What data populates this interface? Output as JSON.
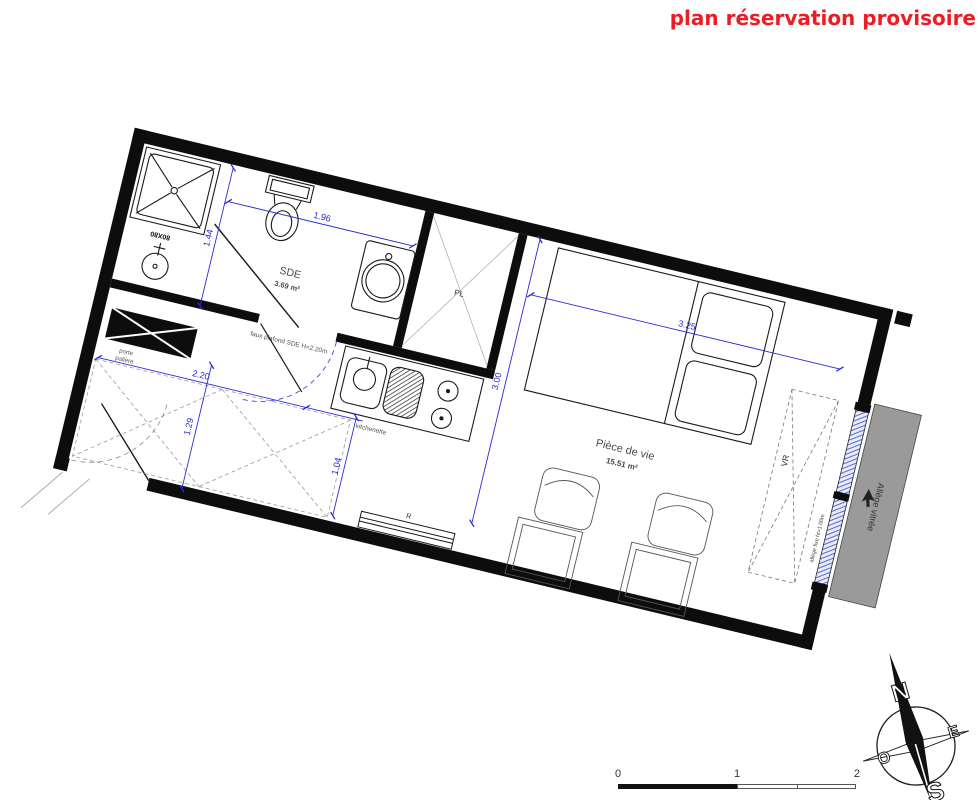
{
  "title": "plan réservation provisoire",
  "plan": {
    "sde_label": "SDE",
    "sde_area": "3.69 m²",
    "sde_note": "faux plafond SDE H=2.20m",
    "living_label": "Pièce de vie",
    "living_area": "15.51 m²",
    "kitchenette_label": "kitchenette",
    "placard_label": "PL",
    "radiator_label": "R",
    "shower_size_label": "80X80",
    "entry_door_line1": "porte",
    "entry_door_line2": "palière",
    "shutter_label": "VR",
    "allege_label": "Allège vitrée",
    "allege_note": "allège fixe ht=1.00m",
    "dims": {
      "sde_width": "1.96",
      "living_width": "3.25",
      "entry_width": "2.20",
      "sde_depth": "1.44",
      "entry_depth": "1.29",
      "kitchen_passage": "1.04",
      "living_depth": "3.00"
    }
  },
  "compass": {
    "north": "N",
    "east": "E",
    "south": "S",
    "west": "O"
  },
  "scalebar": {
    "zero": "0",
    "one": "1",
    "two": "2"
  },
  "colors": {
    "title_red": "#ec1c24",
    "dim_blue": "#2a2ad4",
    "allege_gray": "#9a9a9a"
  }
}
